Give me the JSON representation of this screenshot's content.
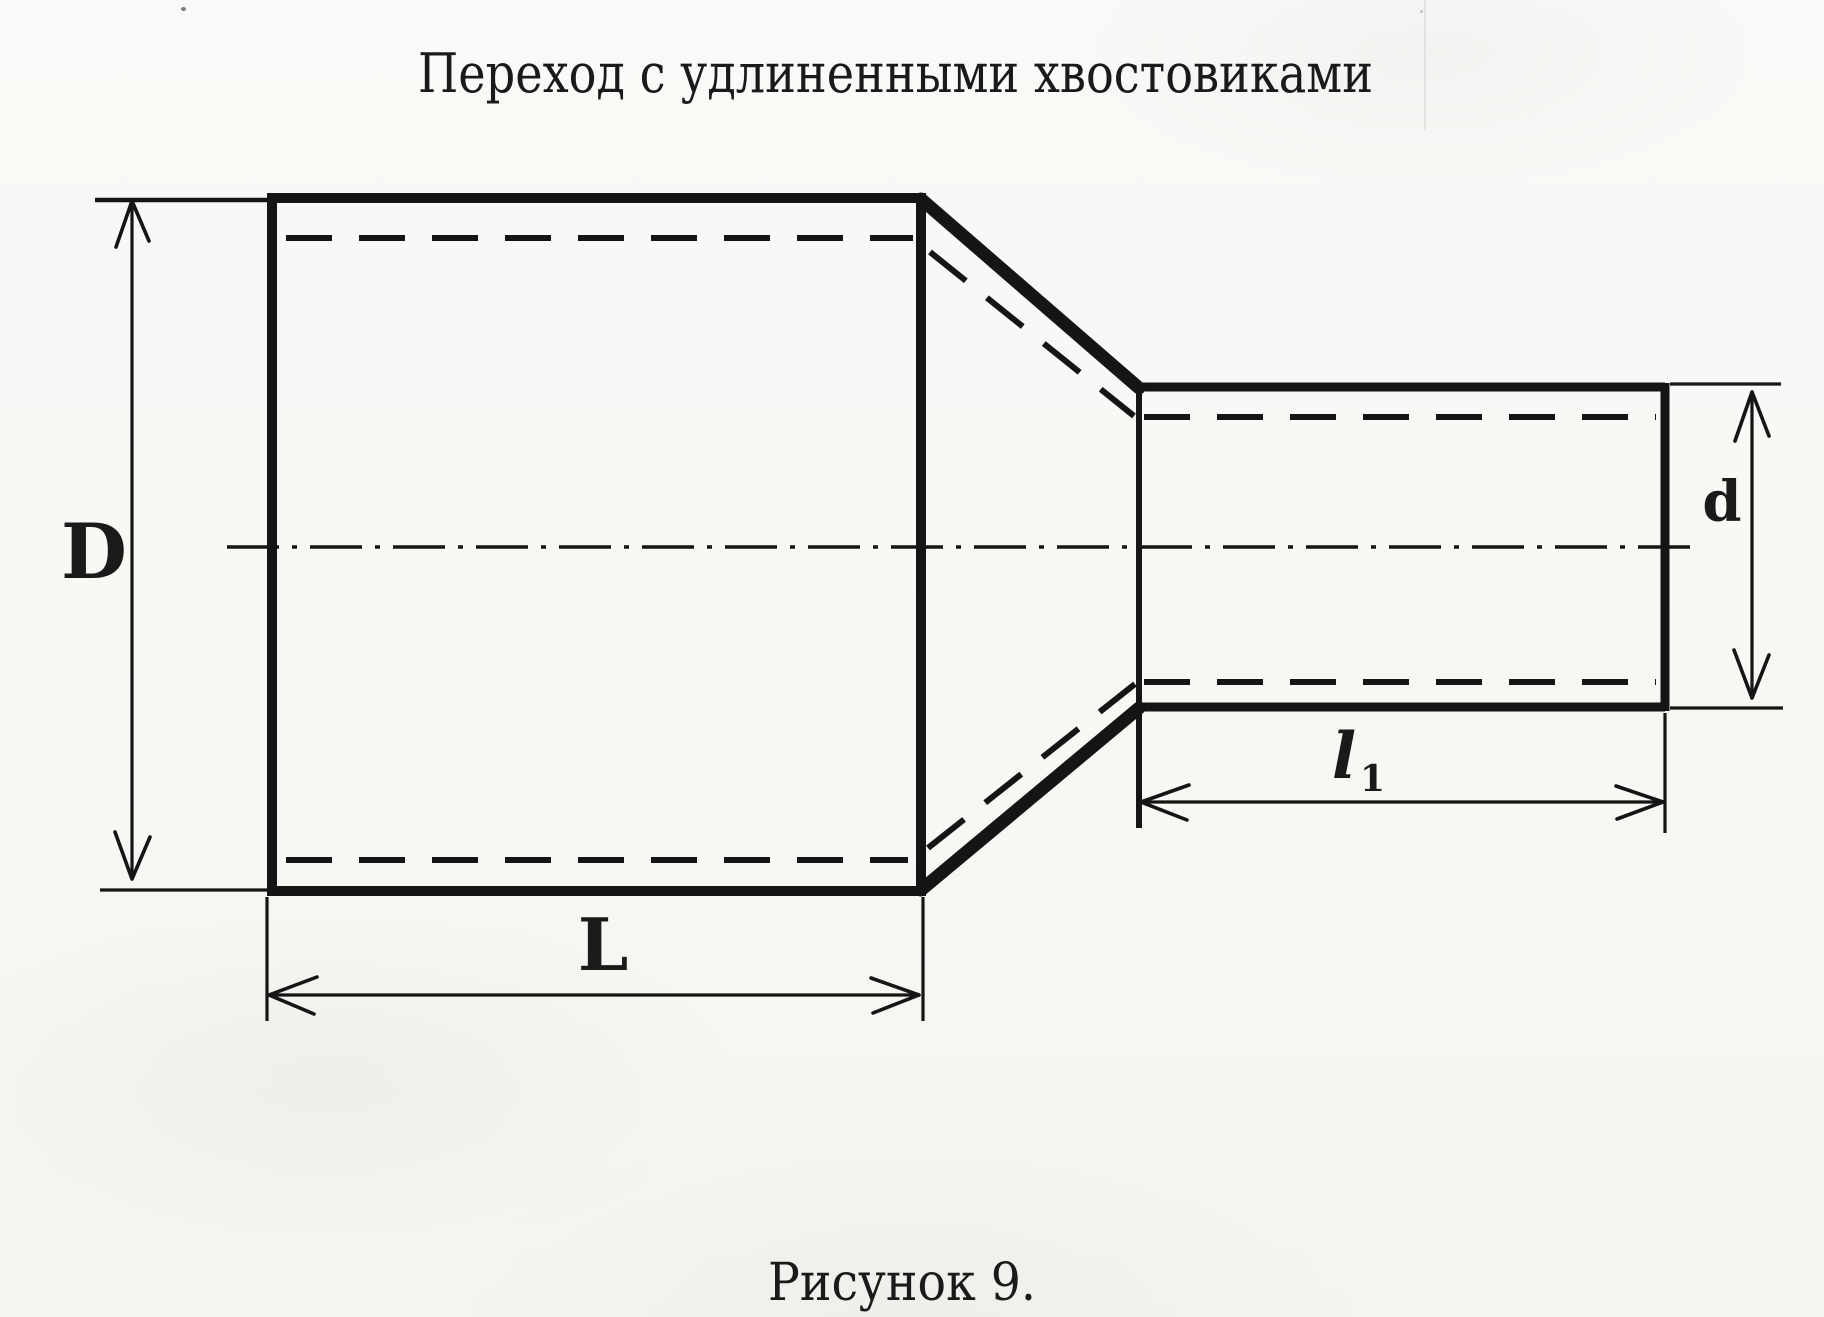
{
  "page": {
    "title": "Переход с удлиненными хвостовиками",
    "caption": "Рисунок 9."
  },
  "drawing": {
    "type": "technical-drawing",
    "subject": "concentric pipe reducer with elongated tails, side view with hidden bore lines and centerline",
    "dimension_labels": {
      "large_diameter": "D",
      "small_diameter": "d",
      "large_body_length": "L",
      "small_tail_length_base": "l",
      "small_tail_length_subscript": "1"
    },
    "colors": {
      "ink": "#151515",
      "paper": "#f8f8f5"
    }
  }
}
